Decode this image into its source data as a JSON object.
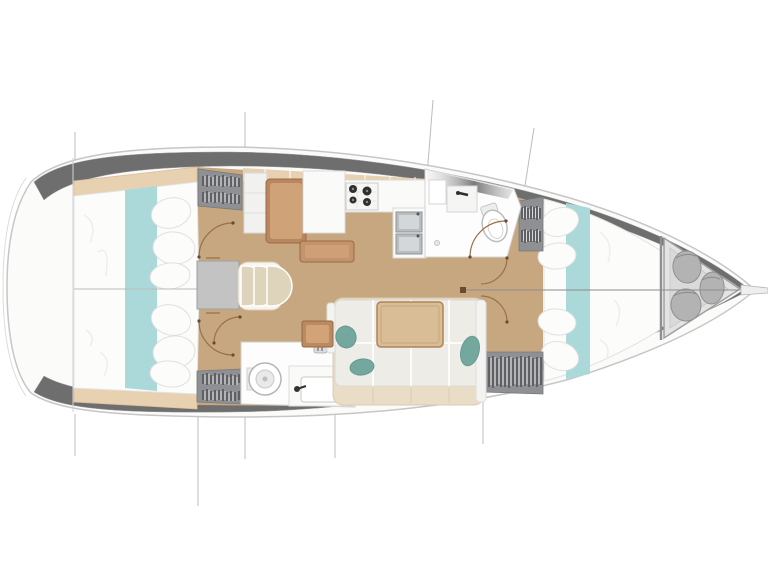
{
  "diagram": {
    "type": "yacht-interior-floor-plan",
    "orientation": "bow-right",
    "rooms": [
      {
        "id": "aft-cabin-port",
        "name": "aft double cabin (top)"
      },
      {
        "id": "aft-cabin-starboard",
        "name": "aft double cabin (bottom)"
      },
      {
        "id": "salon",
        "name": "salon with settee and table"
      },
      {
        "id": "galley",
        "name": "galley with stove and twin sinks"
      },
      {
        "id": "nav-station",
        "name": "chart table and seat"
      },
      {
        "id": "head-forward",
        "name": "forward head with toilet and vanity"
      },
      {
        "id": "head-aft",
        "name": "aft head with toilet and sink"
      },
      {
        "id": "forward-cabin",
        "name": "forward V-berth cabin"
      },
      {
        "id": "bow-locker",
        "name": "bow anchor/sail locker with fenders"
      },
      {
        "id": "companionway",
        "name": "companionway steps and engine box"
      }
    ]
  },
  "colors": {
    "background": "#ffffff",
    "hull_line": "#c6c6c6",
    "deck": "#fbfbfa",
    "gunwale": "#6e6e6e",
    "floor_wood": "#c7a77f",
    "shelf_wood": "#e7d1b0",
    "desk_wood": "#b9875f",
    "island_wood": "#c1946a",
    "table_wood": "#d9bd97",
    "side_table_wood": "#bb8a60",
    "bedding_white": "#fcfcfb",
    "teal_runner": "#abd8d9",
    "teal_pillow": "#74a89f",
    "sofa_cushion": "#edece7",
    "sofa_base": "#e9ddc7",
    "wardrobe_gray": "#8f9093",
    "companionway_gray": "#c3c3c3",
    "step_beige": "#ded3bb",
    "fixture_white": "#fdfdfd",
    "locker_gray": "#e3e3e3",
    "fender_gray": "#b3b3b3",
    "section_line": "#bcbcbc",
    "door_arc": "#9a7048"
  }
}
